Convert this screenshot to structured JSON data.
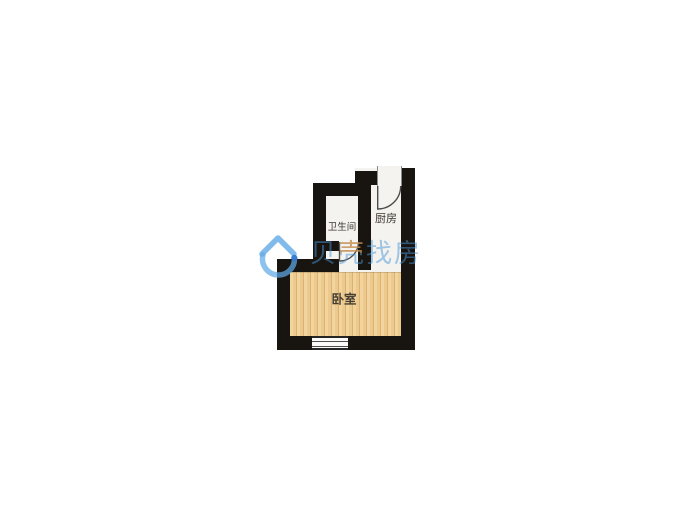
{
  "floorplan": {
    "rooms": {
      "bathroom": {
        "label": "卫生间"
      },
      "kitchen": {
        "label": "厨房"
      },
      "bedroom": {
        "label": "卧室"
      }
    },
    "colors": {
      "wall": "#181410",
      "room_fill": "#f4f3f0",
      "wood_light": "#f2d59e",
      "wood_dark": "#deb173",
      "door_line": "#4c4c4c"
    }
  },
  "watermark": {
    "brand": "贝壳找房",
    "logo_icon": "beike-house-logo",
    "chars": [
      {
        "ch": "贝"
      },
      {
        "ch": "壳"
      },
      {
        "ch": "找"
      },
      {
        "ch": "房"
      }
    ],
    "colors": {
      "blue": "#4896d7",
      "orange": "#ed8a1e"
    }
  }
}
